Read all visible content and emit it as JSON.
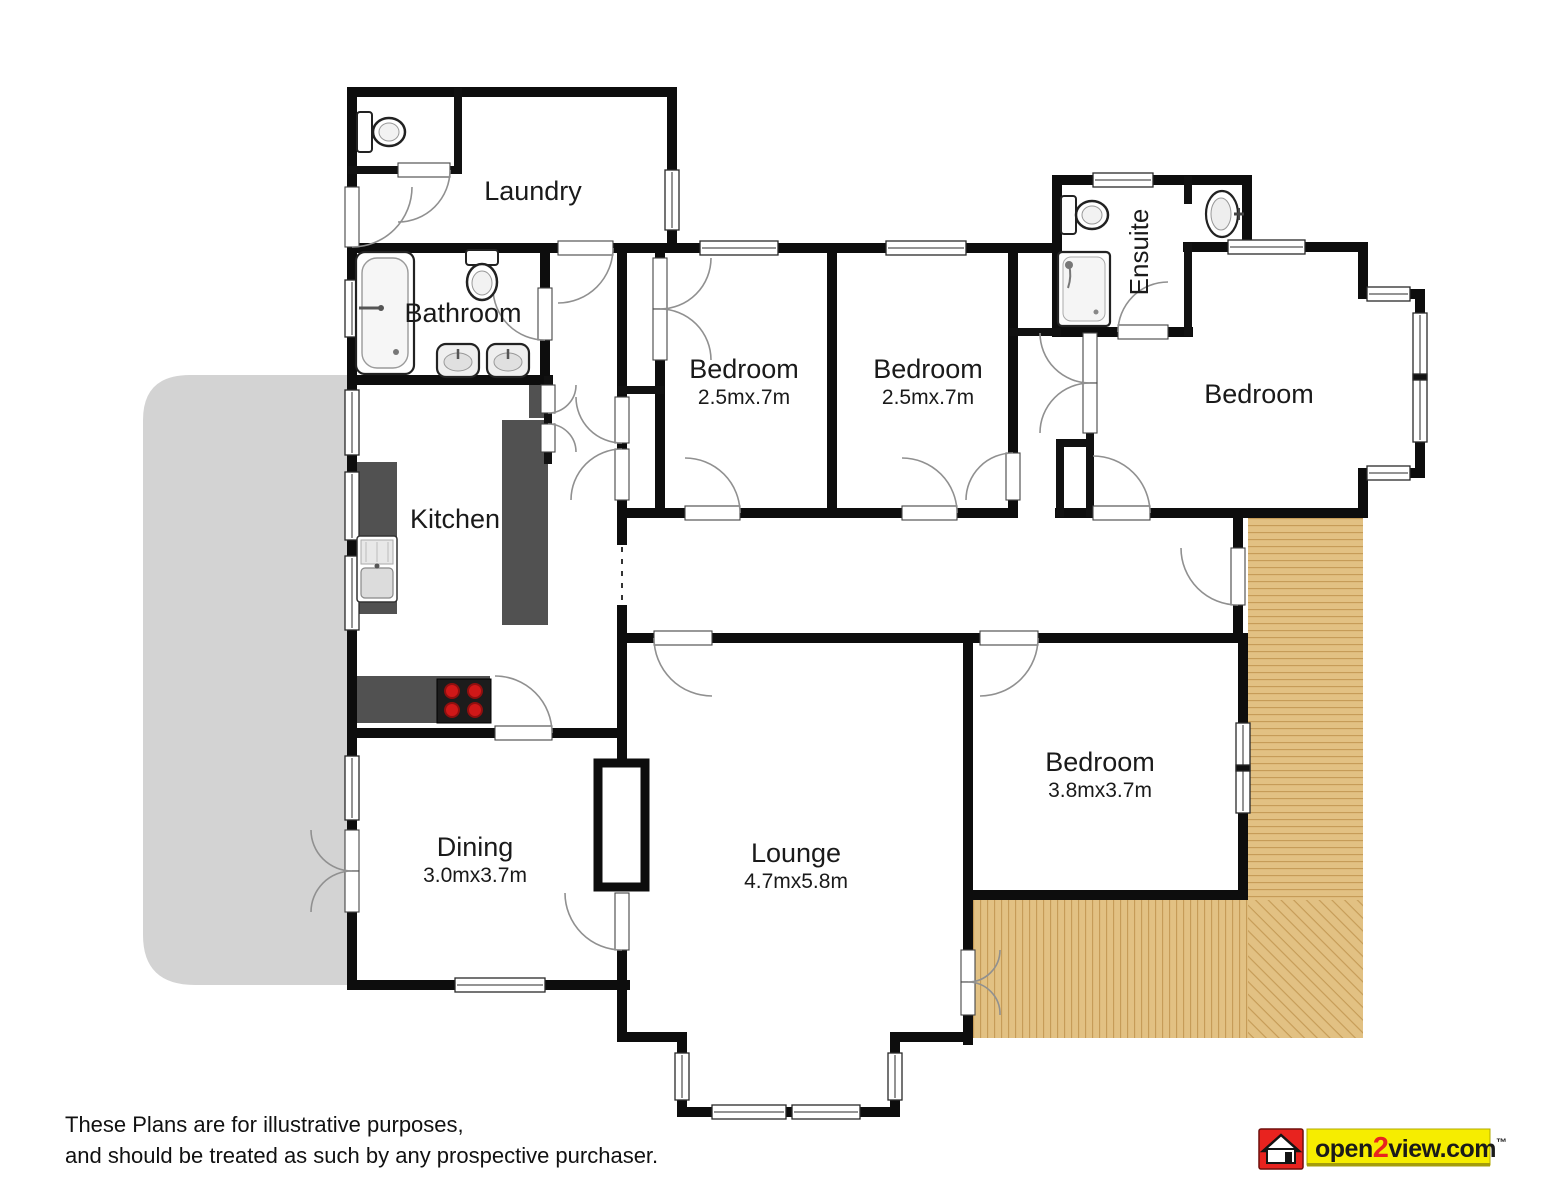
{
  "rooms": [
    {
      "id": "laundry",
      "label": "Laundry"
    },
    {
      "id": "bathroom",
      "label": "Bathroom"
    },
    {
      "id": "kitchen",
      "label": "Kitchen"
    },
    {
      "id": "bedroom-1",
      "label": "Bedroom",
      "dims": "2.5mx.7m"
    },
    {
      "id": "bedroom-2",
      "label": "Bedroom",
      "dims": "2.5mx.7m"
    },
    {
      "id": "ensuite",
      "label": "Ensuite"
    },
    {
      "id": "bedroom-master",
      "label": "Bedroom"
    },
    {
      "id": "bedroom-3",
      "label": "Bedroom",
      "dims": "3.8mx3.7m"
    },
    {
      "id": "dining",
      "label": "Dining",
      "dims": "3.0mx3.7m"
    },
    {
      "id": "lounge",
      "label": "Lounge",
      "dims": "4.7mx5.8m"
    }
  ],
  "disclaimer": {
    "line1": "These Plans are for illustrative purposes,",
    "line2": "and should be treated as such by any prospective purchaser."
  },
  "logo": {
    "open": "open",
    "two": "2",
    "rest": "view.com",
    "tm": "™"
  },
  "fixtures": [
    "toilet",
    "bath",
    "basin",
    "basin",
    "toilet",
    "shower",
    "basin",
    "kitchen-sink",
    "hob",
    "fireplace"
  ],
  "colors": {
    "wall": "#0d0d0d",
    "minor_wall": "#111111",
    "patio": "#d3d3d3",
    "deck": "#e2c183",
    "deck_line": "#c49a55",
    "counter": "#515151",
    "burner": "#c41414",
    "arc": "#909090",
    "logo_red": "#e8231f",
    "logo_yellow": "#f6ed00",
    "logo_shadow": "#a49d0a"
  }
}
